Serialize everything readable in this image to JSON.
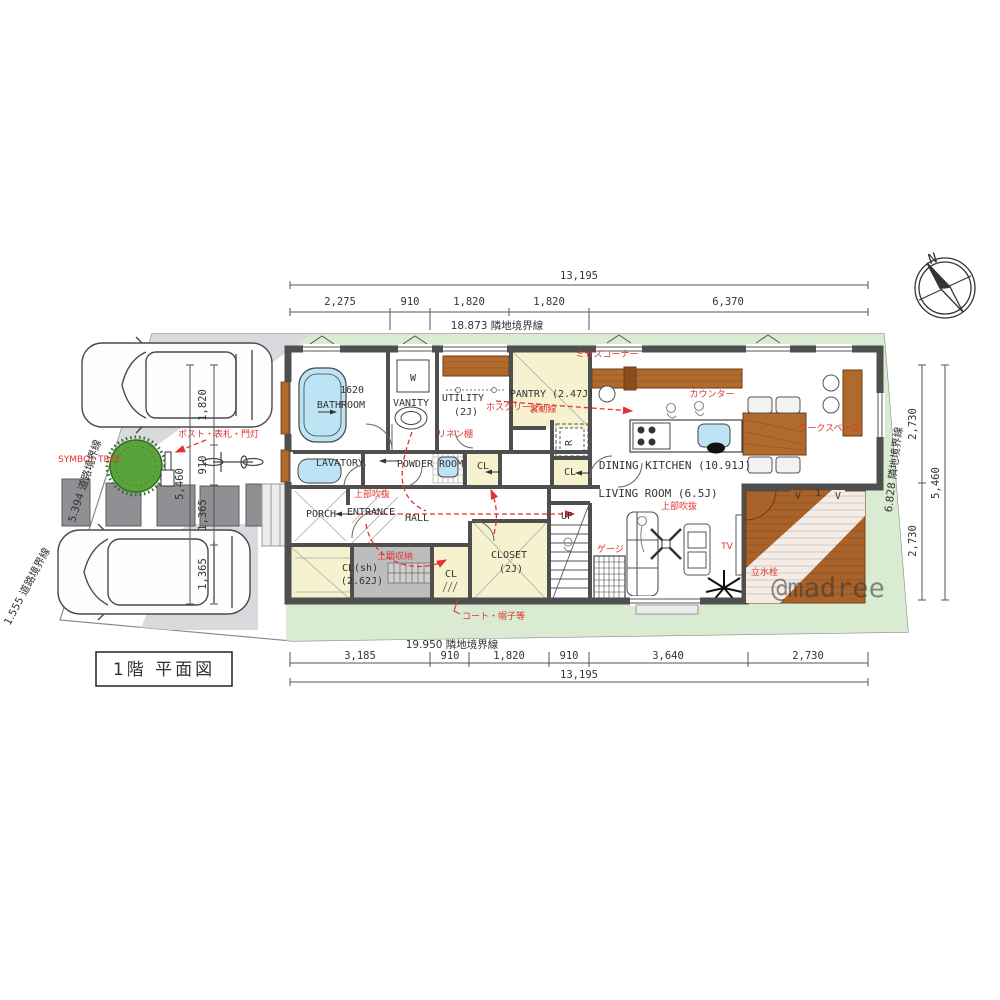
{
  "title": "1階 平面図",
  "compass": {
    "north": "N"
  },
  "watermark": "@madree",
  "site": {
    "symbol_tree": "SYMBOL TREE",
    "post_label": "ポスト・表札・門灯",
    "boundary_road_upper": "5.394 道路境界線",
    "boundary_road_lower": "1.555 道路境界線"
  },
  "dims": {
    "top": {
      "overall": "13,195",
      "segments": [
        "2,275",
        "910",
        "1,820",
        "1,820",
        "6,370"
      ],
      "boundary": "18.873 隣地境界線"
    },
    "bottom": {
      "boundary": "19.950 隣地境界線",
      "segments": [
        "3,185",
        "910",
        "1,820",
        "910",
        "3,640",
        "2,730"
      ],
      "overall": "13,195"
    },
    "right": {
      "boundary": "6.828 隣地境界線",
      "segments": [
        "2,730",
        "2,730"
      ],
      "overall": "5,460"
    },
    "left": {
      "overall": "5,460",
      "segments": [
        "1,820",
        "910",
        "1,365",
        "1,365"
      ]
    }
  },
  "rooms": {
    "bathroom": {
      "name": "BATHROOM",
      "size": "1620"
    },
    "vanity": {
      "name": "VANITY"
    },
    "washer": "W",
    "utility": {
      "name": "UTILITY",
      "size": "(2J)"
    },
    "pantry": {
      "name": "PANTRY (2.47J)"
    },
    "fridge": "R",
    "cl_powder": "CL",
    "cl_fridge": "CL",
    "cl_coat": "CL",
    "dining": "DINING KITCHEN (10.91J)",
    "living": "LIVING ROOM (6.5J)",
    "lavatory": "LAVATORY",
    "powder": "POWDER ROOM",
    "hall": "HALL",
    "entrance": "ENTRANCE",
    "porch": "PORCH",
    "stairs_up": "UP",
    "closet": {
      "name": "CLOSET",
      "size": "(2J)"
    },
    "cl_sh": {
      "name": "CL(sh)",
      "size": "(2.62J)"
    }
  },
  "annotations": {
    "mrs_corner": "ミセスコーナー",
    "hosukreen": "ホスクリーン",
    "linen_shelf": "リネン棚",
    "back_line": "裏動線",
    "counter": "カウンター",
    "workspace": "ワークスペース",
    "void_entrance": "上部吹抜",
    "void_living": "上部吹抜",
    "doma_storage": "土間収納",
    "coat_hat": "コート・帽子等",
    "cage": "ゲージ",
    "tv": "TV",
    "faucet": "立水栓"
  },
  "deck_marks": [
    "V",
    "1",
    "V"
  ],
  "colors": {
    "lawn": "#d9ecd2",
    "wood": "#b06a2c",
    "tub_blue": "#bce4f5",
    "wall": "#4f4f4f",
    "annotation_red": "#e23333",
    "closet_cream": "#f6f2cf",
    "doma_gray": "#bdbdbd",
    "paving_gray": "#8f9094"
  }
}
